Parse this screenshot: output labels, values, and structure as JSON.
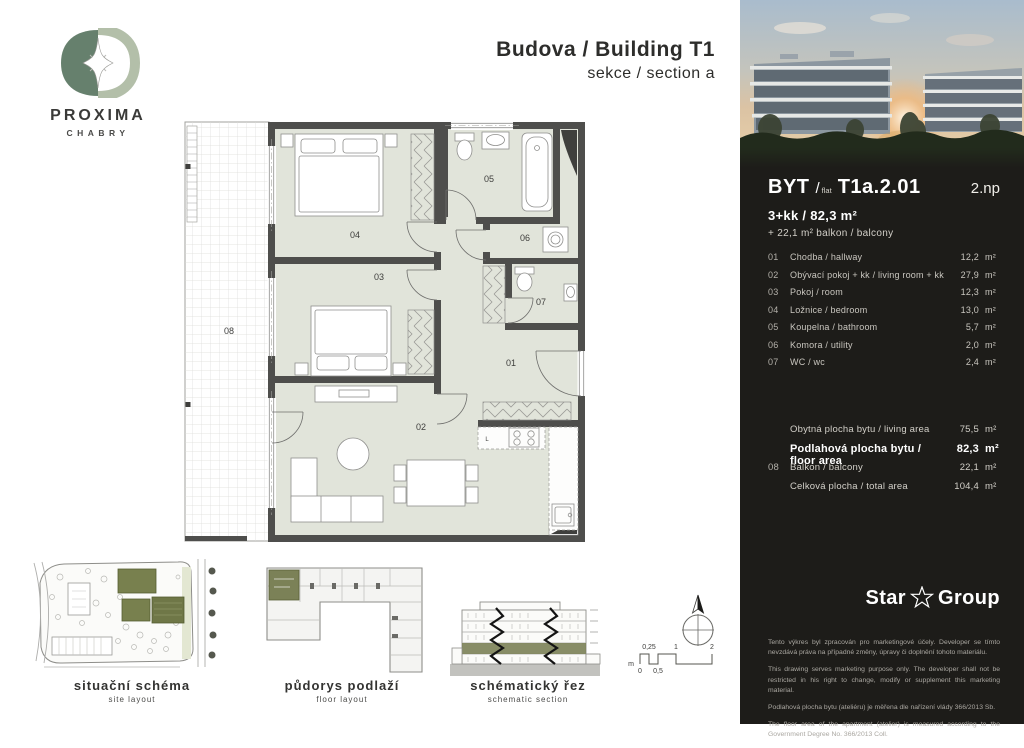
{
  "logo": {
    "name": "PROXIMA",
    "city": "CHABRY"
  },
  "header": {
    "line1": "Budova / Building T1",
    "line2": "sekce / section a"
  },
  "plan": {
    "labels": {
      "r01": "01",
      "r02": "02",
      "r03": "03",
      "r04": "04",
      "r05": "05",
      "r06": "06",
      "r07": "07",
      "r08": "08",
      "kitchen": "L"
    }
  },
  "diagrams": {
    "site": {
      "cs": "situační schéma",
      "en": "site layout"
    },
    "floor": {
      "cs": "půdorys podlaží",
      "en": "floor layout"
    },
    "section": {
      "cs": "schématický řez",
      "en": "schematic section"
    }
  },
  "scalebar": {
    "unit": "m",
    "m0": "0",
    "m025": "0,25",
    "m05": "0,5",
    "m1": "1",
    "m2": "2"
  },
  "sidebar": {
    "flat_label": "BYT",
    "flat_slash": "/",
    "flat_word": "flat",
    "flat_code": "T1a.2.01",
    "floor": "2.np",
    "disposition": "3+kk / 82,3 m²",
    "balcony_line": "+ 22,1 m² balkon / balcony",
    "rooms": [
      {
        "num": "01",
        "label": "Chodba / hallway",
        "area": "12,2",
        "unit": "m²"
      },
      {
        "num": "02",
        "label": "Obývací pokoj + kk / living room + kk",
        "area": "27,9",
        "unit": "m²"
      },
      {
        "num": "03",
        "label": "Pokoj / room",
        "area": "12,3",
        "unit": "m²"
      },
      {
        "num": "04",
        "label": "Ložnice / bedroom",
        "area": "13,0",
        "unit": "m²"
      },
      {
        "num": "05",
        "label": "Koupelna / bathroom",
        "area": "5,7",
        "unit": "m²"
      },
      {
        "num": "06",
        "label": "Komora / utility",
        "area": "2,0",
        "unit": "m²"
      },
      {
        "num": "07",
        "label": "WC / wc",
        "area": "2,4",
        "unit": "m²"
      }
    ],
    "totals": [
      {
        "num": "",
        "label": "Obytná plocha bytu / living area",
        "area": "75,5",
        "unit": "m²",
        "bold": false
      },
      {
        "num": "",
        "label": "Podlahová plocha bytu / floor area",
        "area": "82,3",
        "unit": "m²",
        "bold": true
      },
      {
        "num": "08",
        "label": "Balkon / balcony",
        "area": "22,1",
        "unit": "m²",
        "bold": false
      },
      {
        "num": "",
        "label": "Celková plocha / total area",
        "area": "104,4",
        "unit": "m²",
        "bold": false
      }
    ],
    "brand": {
      "word1": "Star",
      "word2": "Group"
    },
    "legal": [
      "Tento výkres byl zpracován pro marketingové účely. Developer se tímto nevzdává práva na případné změny, úpravy či doplnění tohoto materiálu.",
      "This drawing serves marketing purpose only. The developer shall not be restricted in his right to change, modify or supplement this marketing material.",
      "Podlahová plocha bytu (ateliéru) je měřena dle nařízení vlády 366/2013 Sb.",
      "The floor area of the apartment (atelier) is measured according to the Government Degree No. 366/2013 Coll."
    ],
    "colors": {
      "sidebar_bg": "#1d1c19",
      "room_fill": "#e1e4da",
      "wall": "#4e4e4c",
      "olive_accent": "#7b8157"
    }
  }
}
